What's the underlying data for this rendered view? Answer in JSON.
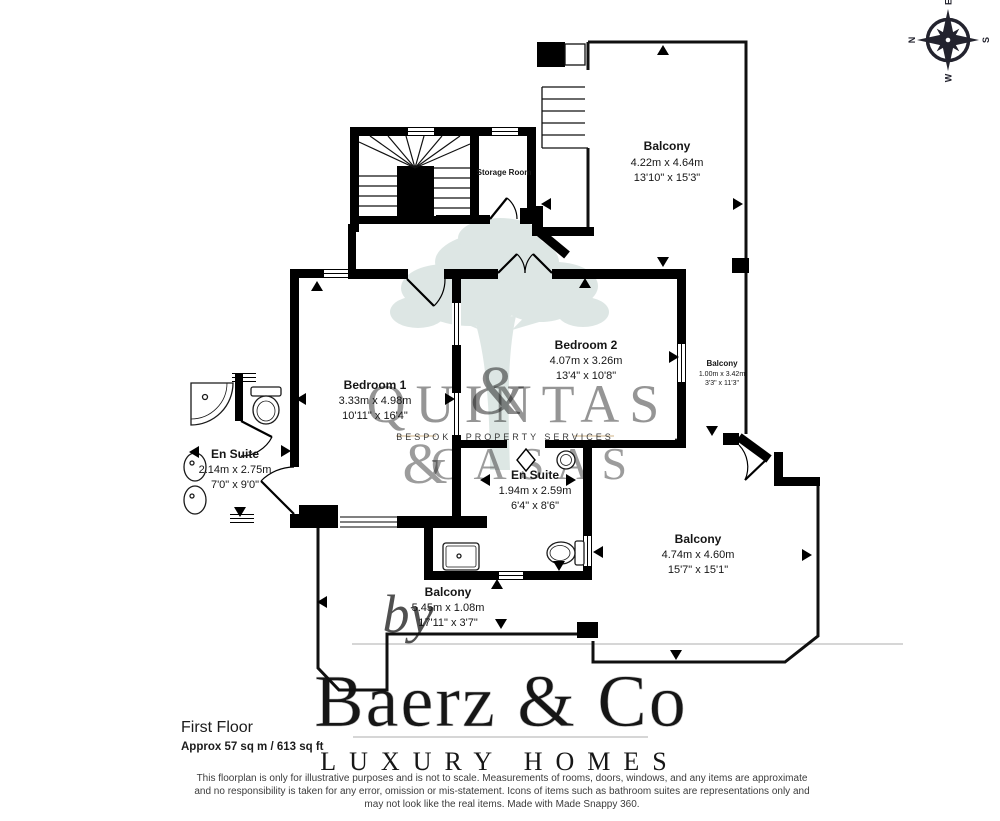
{
  "compass": {
    "north": "N",
    "east": "E",
    "south": "S",
    "west": "W"
  },
  "plan": {
    "storage_room_label": "Storage Room",
    "rooms": [
      {
        "name": "Balcony",
        "metric": "4.22m x 4.64m",
        "imperial": "13'10\" x 15'3\""
      },
      {
        "name": "Bedroom 2",
        "metric": "4.07m x 3.26m",
        "imperial": "13'4\" x 10'8\""
      },
      {
        "name": "Bedroom 1",
        "metric": "3.33m x 4.98m",
        "imperial": "10'11\" x 16'4\""
      },
      {
        "name": "Balcony",
        "metric": "1.00m x 3.42m",
        "imperial": "3'3\" x 11'3\""
      },
      {
        "name": "En Suite",
        "metric": "2.14m x 2.75m",
        "imperial": "7'0\" x 9'0\""
      },
      {
        "name": "En Suite",
        "metric": "1.94m x 2.59m",
        "imperial": "6'4\" x 8'6\""
      },
      {
        "name": "Balcony",
        "metric": "4.74m x 4.60m",
        "imperial": "15'7\" x 15'1\""
      },
      {
        "name": "Balcony",
        "metric": "5.45m x 1.08m",
        "imperial": "17'11\" x 3'7\""
      }
    ]
  },
  "watermarks": {
    "brand": {
      "line1": "QUINTAS",
      "ampersand": "&",
      "line2": "CASAS",
      "tagline": "BESPOKE PROPERTY SERVICES"
    },
    "agency": {
      "by": "by",
      "name": "Baerz & Co",
      "tagline": "LUXURY HOMES"
    }
  },
  "footer": {
    "floor_title": "First Floor",
    "floor_area": "Approx 57 sq m / 613 sq ft",
    "disclaimer": {
      "line1": "This floorplan is only for illustrative purposes and is not to scale. Measurements of rooms, doors, windows, and any items are approximate",
      "line2": "and no responsibility is taken for any error, omission or mis-statement. Icons of items such as bathroom suites are representations only and",
      "line3": "may not look like the real items. Made with Made Snappy 360."
    }
  },
  "colors": {
    "wall": "#000000",
    "tree_watermark": "#b9cec9",
    "brand_text": "#9fb4bf",
    "brand_gold": "#bf9a5f",
    "agency_text": "#d8d8d8"
  }
}
